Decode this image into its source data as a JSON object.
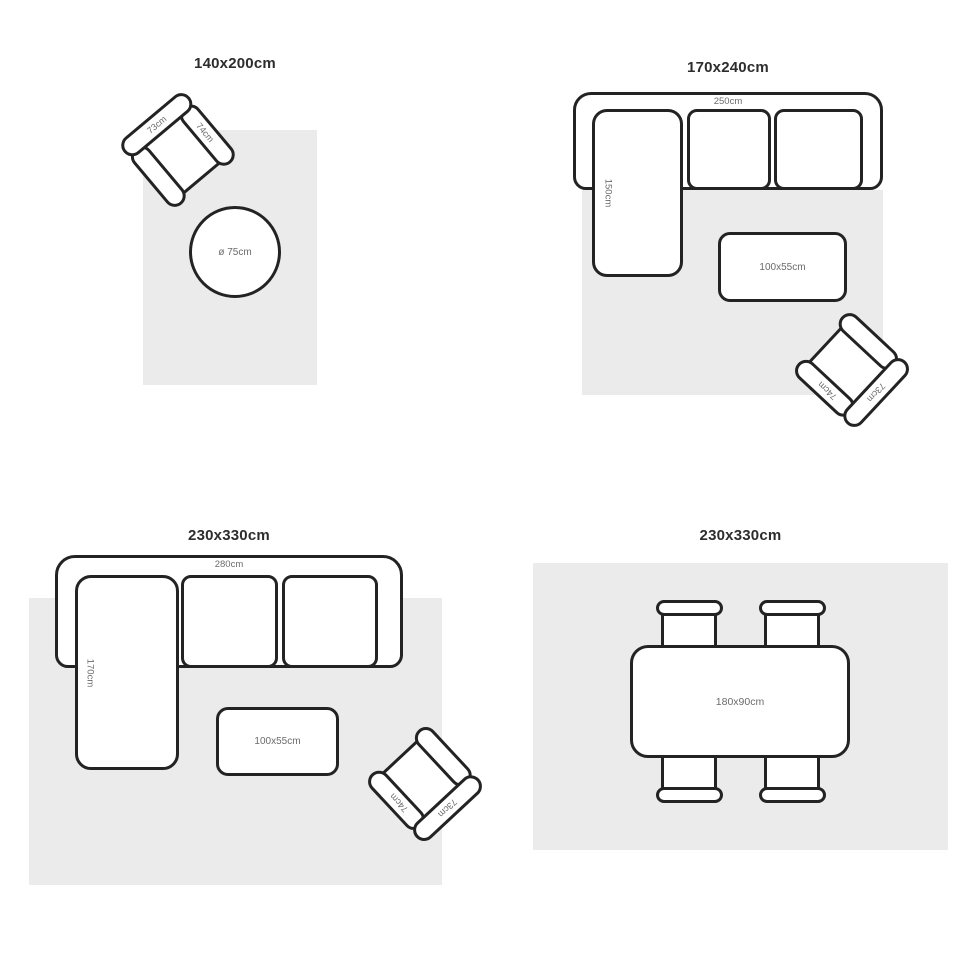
{
  "colors": {
    "background": "#ffffff",
    "rug_fill": "#ebebeb",
    "outline": "#232323",
    "dim_label": "#6b6b6b",
    "title": "#2d2d2d"
  },
  "panels": {
    "p1": {
      "title": "140x200cm",
      "round_table_label": "ø 75cm",
      "armchair": {
        "back_label": "73cm",
        "arm_label": "74cm"
      }
    },
    "p2": {
      "title": "170x240cm",
      "sofa_width_label": "250cm",
      "chaise_label": "150cm",
      "coffee_table_label": "100x55cm",
      "armchair": {
        "back_label": "73cm",
        "arm_label": "74cm"
      }
    },
    "p3": {
      "title": "230x330cm",
      "sofa_width_label": "280cm",
      "chaise_label": "170cm",
      "coffee_table_label": "100x55cm",
      "armchair": {
        "back_label": "73cm",
        "arm_label": "74cm"
      }
    },
    "p4": {
      "title": "230x330cm",
      "dining_table_label": "180x90cm"
    }
  }
}
